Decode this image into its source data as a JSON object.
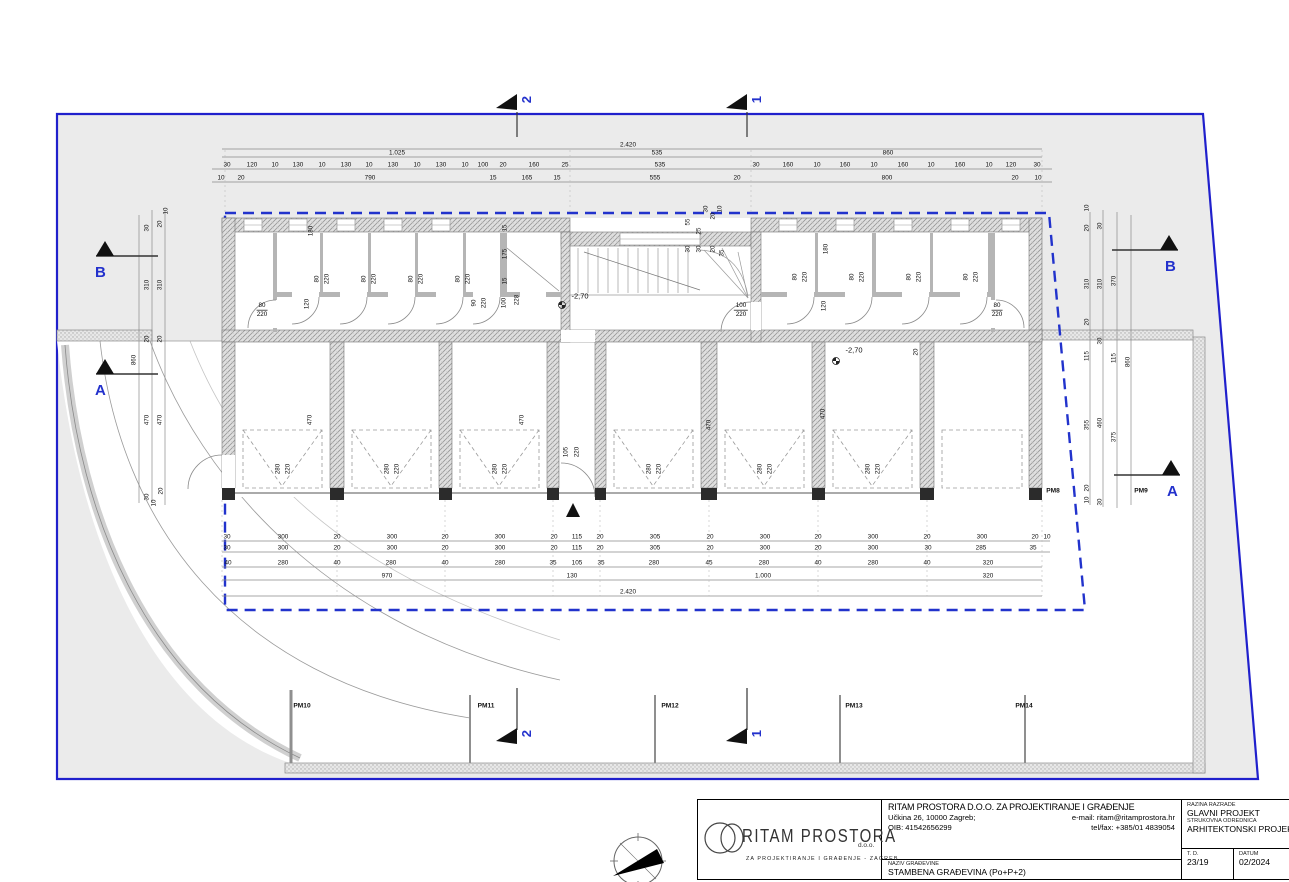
{
  "sheet_title": "STAMBENA GRAĐEVINA (Po+P+2)",
  "tb": {
    "company": "RITAM PROSTORA D.O.O. ZA PROJEKTIRANJE I GRAĐENJE",
    "address": "Učkina 26, 10000 Zagreb;",
    "email": "e-mail: ritam@ritamprostora.hr",
    "oib": "OIB: 41542656299",
    "telfax": "tel/fax: +385/01 4839054",
    "naziv_label": "NAZIV GRAĐEVINE",
    "naziv_value": "STAMBENA GRAĐEVINA (Po+P+2)",
    "razina_label": "RAZINA RAZRADE",
    "razina_value": "GLAVNI PROJEKT",
    "struk_label": "STRUKOVNA ODREDNICA",
    "struk_value": "ARHITEKTONSKI PROJEKT",
    "td_label": "T. D.",
    "td_value": "23/19",
    "datum_label": "DATUM",
    "datum_value": "02/2024",
    "logo_main": "RITAM PROSTORA",
    "logo_doo": "d.o.o.",
    "logo_sub": "ZA  PROJEKTIRANJE  I  GRAĐENJE  -  ZAGREB"
  },
  "markers": {
    "top": [
      {
        "label": "2"
      },
      {
        "label": "1"
      }
    ],
    "bottom": [
      {
        "label": "2"
      },
      {
        "label": "1"
      }
    ],
    "left": [
      {
        "label": "B"
      },
      {
        "label": "A"
      }
    ],
    "right": [
      {
        "label": "B"
      },
      {
        "label": "A"
      }
    ]
  },
  "colors": {
    "parcel_line": "#2020cc",
    "envelope_dash": "#2233cc",
    "marker_blue": "#2331cc"
  },
  "plan": {
    "rooms": [
      {
        "name": "SPREMIŠTE 1",
        "sub": "ker.pl.",
        "area": "3,72 m²",
        "x": 253,
        "y": 262
      },
      {
        "name": "SPREMIŠTE 2",
        "sub": "ker.pl.",
        "area": "2,34 m²",
        "x": 298,
        "y": 244
      },
      {
        "name": "SPREMIŠTE 3",
        "sub": "ker.pl.",
        "area": "2,34 m²",
        "x": 346,
        "y": 230
      },
      {
        "name": "SPREMIŠTE 4",
        "sub": "ker.pl.",
        "area": "2,34 m²",
        "x": 393,
        "y": 246
      },
      {
        "name": "SPREMIŠTE 5",
        "sub": "ker.pl.",
        "area": "2,34 m²",
        "x": 441,
        "y": 230
      },
      {
        "name": "STROJARNICA",
        "name2": "DIZALA",
        "sub": "BPP",
        "area": "1,80 m²",
        "x": 483,
        "y": 243
      },
      {
        "name": "DIZALO",
        "sub": "",
        "area": "2,80 m²",
        "x": 534,
        "y": 247
      },
      {
        "name": "HODNIK",
        "sub": "ker.pl.",
        "area": "8,19 m²",
        "x": 387,
        "y": 296
      },
      {
        "name": "HODNIK / STUBIŠTE",
        "sub": "ker.pl.",
        "area": "22,04 m²",
        "x": 680,
        "y": 292
      },
      {
        "name": "SPREMIŠTE 6",
        "sub": "ker.pl.",
        "area": "2,88 m²",
        "x": 788,
        "y": 239
      },
      {
        "name": "SPREMIŠTE 7",
        "sub": "ker.pl.",
        "area": "2,88 m²",
        "x": 845,
        "y": 239
      },
      {
        "name": "SPREMIŠTE 8",
        "sub": "ker.pl.",
        "area": "2,88 m²",
        "x": 903,
        "y": 239
      },
      {
        "name": "SPREMIŠTE 9",
        "sub": "ker.pl.",
        "area": "2,88 m²",
        "x": 960,
        "y": 239
      },
      {
        "name": "SPREMIŠTE 10",
        "sub": "ker.pl.",
        "area": "3,72 m²",
        "x": 1011,
        "y": 264
      },
      {
        "name": "HODNIK",
        "sub": "ker.pl.",
        "area": "8,36 m²",
        "x": 857,
        "y": 296
      },
      {
        "name": "GARAŽNO PARKIRNO",
        "name2": "MJESTO 1",
        "sub": "BPP",
        "area": "14,70 m²",
        "x": 283,
        "y": 386
      },
      {
        "name": "GARAŽNO PARKIRNO",
        "name2": "MJESTO 2",
        "sub": "BPP",
        "area": "14,70 m²",
        "x": 392,
        "y": 386
      },
      {
        "name": "GARAŽNO PARKIRNO",
        "name2": "MJESTO 3",
        "sub": "BPP",
        "area": "14,70 m²",
        "x": 500,
        "y": 386
      },
      {
        "name": "GARAŽNO PARKIRNO",
        "name2": "MJESTO 4",
        "sub": "BPP",
        "area": "14,95 m²",
        "x": 654,
        "y": 386
      },
      {
        "name": "GARAŽNO PARKIRNO",
        "name2": "MJESTO 5",
        "sub": "BPP",
        "area": "14,70 m²",
        "x": 765,
        "y": 386
      },
      {
        "name": "GARAŽNO PARKIRNO",
        "name2": "MJESTO 6",
        "sub": "BPP",
        "area": "14,70 m²",
        "x": 873,
        "y": 386
      },
      {
        "name": "NATKRIVENO PARKIRNO",
        "name2": "MJESTO 7",
        "sub": "BPP",
        "area": "15,28 m²",
        "x": 982,
        "y": 386
      }
    ],
    "dims_top": [
      {
        "y": 145,
        "items": [
          {
            "t": "2.420",
            "x": 628
          }
        ]
      },
      {
        "y": 153,
        "items": [
          {
            "t": "1.025",
            "x": 397
          },
          {
            "t": "535",
            "x": 657
          },
          {
            "t": "860",
            "x": 888
          }
        ]
      },
      {
        "y": 165,
        "items": [
          {
            "t": "30",
            "x": 227
          },
          {
            "t": "120",
            "x": 252
          },
          {
            "t": "10",
            "x": 275
          },
          {
            "t": "130",
            "x": 298
          },
          {
            "t": "10",
            "x": 322
          },
          {
            "t": "130",
            "x": 346
          },
          {
            "t": "10",
            "x": 369
          },
          {
            "t": "130",
            "x": 393
          },
          {
            "t": "10",
            "x": 417
          },
          {
            "t": "130",
            "x": 441
          },
          {
            "t": "10",
            "x": 465
          },
          {
            "t": "100",
            "x": 483
          },
          {
            "t": "20",
            "x": 503
          },
          {
            "t": "160",
            "x": 534
          },
          {
            "t": "25",
            "x": 565
          },
          {
            "t": "535",
            "x": 660
          },
          {
            "t": "30",
            "x": 756
          },
          {
            "t": "160",
            "x": 788
          },
          {
            "t": "10",
            "x": 817
          },
          {
            "t": "160",
            "x": 845
          },
          {
            "t": "10",
            "x": 874
          },
          {
            "t": "160",
            "x": 903
          },
          {
            "t": "10",
            "x": 931
          },
          {
            "t": "160",
            "x": 960
          },
          {
            "t": "10",
            "x": 989
          },
          {
            "t": "120",
            "x": 1011
          },
          {
            "t": "30",
            "x": 1037
          }
        ]
      },
      {
        "y": 178,
        "items": [
          {
            "t": "10",
            "x": 221
          },
          {
            "t": "20",
            "x": 241
          },
          {
            "t": "790",
            "x": 370
          },
          {
            "t": "15",
            "x": 493
          },
          {
            "t": "165",
            "x": 527
          },
          {
            "t": "15",
            "x": 557
          },
          {
            "t": "555",
            "x": 655
          },
          {
            "t": "20",
            "x": 737
          },
          {
            "t": "800",
            "x": 887
          },
          {
            "t": "20",
            "x": 1015
          },
          {
            "t": "10",
            "x": 1038
          }
        ]
      }
    ],
    "dims_bottom": [
      {
        "y": 537,
        "items": [
          {
            "t": "30",
            "x": 227
          },
          {
            "t": "300",
            "x": 283
          },
          {
            "t": "20",
            "x": 337
          },
          {
            "t": "300",
            "x": 392
          },
          {
            "t": "20",
            "x": 445
          },
          {
            "t": "300",
            "x": 500
          },
          {
            "t": "20",
            "x": 554
          },
          {
            "t": "115",
            "x": 577
          },
          {
            "t": "20",
            "x": 600
          },
          {
            "t": "305",
            "x": 655
          },
          {
            "t": "20",
            "x": 710
          },
          {
            "t": "300",
            "x": 765
          },
          {
            "t": "20",
            "x": 818
          },
          {
            "t": "300",
            "x": 873
          },
          {
            "t": "20",
            "x": 927
          },
          {
            "t": "300",
            "x": 982
          },
          {
            "t": "20",
            "x": 1035
          },
          {
            "t": "10",
            "x": 1047
          }
        ]
      },
      {
        "y": 548,
        "items": [
          {
            "t": "30",
            "x": 227
          },
          {
            "t": "300",
            "x": 283
          },
          {
            "t": "20",
            "x": 337
          },
          {
            "t": "300",
            "x": 392
          },
          {
            "t": "20",
            "x": 445
          },
          {
            "t": "300",
            "x": 500
          },
          {
            "t": "20",
            "x": 554
          },
          {
            "t": "115",
            "x": 577
          },
          {
            "t": "20",
            "x": 600
          },
          {
            "t": "305",
            "x": 655
          },
          {
            "t": "20",
            "x": 710
          },
          {
            "t": "300",
            "x": 765
          },
          {
            "t": "20",
            "x": 818
          },
          {
            "t": "300",
            "x": 873
          },
          {
            "t": "30",
            "x": 928
          },
          {
            "t": "285",
            "x": 981
          },
          {
            "t": "35",
            "x": 1033
          }
        ]
      },
      {
        "y": 563,
        "items": [
          {
            "t": "40",
            "x": 228
          },
          {
            "t": "280",
            "x": 283
          },
          {
            "t": "40",
            "x": 337
          },
          {
            "t": "280",
            "x": 391
          },
          {
            "t": "40",
            "x": 445
          },
          {
            "t": "280",
            "x": 500
          },
          {
            "t": "35",
            "x": 553
          },
          {
            "t": "105",
            "x": 577
          },
          {
            "t": "35",
            "x": 601
          },
          {
            "t": "280",
            "x": 654
          },
          {
            "t": "45",
            "x": 709
          },
          {
            "t": "280",
            "x": 764
          },
          {
            "t": "40",
            "x": 818
          },
          {
            "t": "280",
            "x": 873
          },
          {
            "t": "40",
            "x": 927
          },
          {
            "t": "320",
            "x": 988
          }
        ]
      },
      {
        "y": 576,
        "items": [
          {
            "t": "970",
            "x": 387
          },
          {
            "t": "130",
            "x": 572
          },
          {
            "t": "1.000",
            "x": 763
          },
          {
            "t": "320",
            "x": 988
          }
        ]
      },
      {
        "y": 592,
        "items": [
          {
            "t": "2.420",
            "x": 628
          }
        ]
      }
    ],
    "dims_left": [
      {
        "t": "10",
        "x": 166,
        "y": 211
      },
      {
        "t": "20",
        "x": 160,
        "y": 224
      },
      {
        "t": "30",
        "x": 147,
        "y": 228
      },
      {
        "t": "310",
        "x": 147,
        "y": 285
      },
      {
        "t": "310",
        "x": 160,
        "y": 285
      },
      {
        "t": "20",
        "x": 147,
        "y": 339
      },
      {
        "t": "20",
        "x": 160,
        "y": 339
      },
      {
        "t": "860",
        "x": 134,
        "y": 360
      },
      {
        "t": "470",
        "x": 147,
        "y": 420
      },
      {
        "t": "470",
        "x": 160,
        "y": 420
      },
      {
        "t": "30",
        "x": 147,
        "y": 497
      },
      {
        "t": "10",
        "x": 154,
        "y": 503
      },
      {
        "t": "20",
        "x": 161,
        "y": 491
      }
    ],
    "dims_right": [
      {
        "t": "10",
        "x": 1087,
        "y": 208
      },
      {
        "t": "20",
        "x": 1087,
        "y": 228
      },
      {
        "t": "30",
        "x": 1100,
        "y": 226
      },
      {
        "t": "310",
        "x": 1087,
        "y": 284
      },
      {
        "t": "310",
        "x": 1100,
        "y": 284
      },
      {
        "t": "370",
        "x": 1114,
        "y": 281
      },
      {
        "t": "20",
        "x": 1087,
        "y": 322
      },
      {
        "t": "30",
        "x": 1100,
        "y": 341
      },
      {
        "t": "115",
        "x": 1087,
        "y": 356
      },
      {
        "t": "115",
        "x": 1114,
        "y": 358
      },
      {
        "t": "860",
        "x": 1128,
        "y": 362
      },
      {
        "t": "355",
        "x": 1087,
        "y": 425
      },
      {
        "t": "460",
        "x": 1100,
        "y": 423
      },
      {
        "t": "375",
        "x": 1114,
        "y": 437
      },
      {
        "t": "20",
        "x": 1087,
        "y": 488
      },
      {
        "t": "10",
        "x": 1087,
        "y": 500
      },
      {
        "t": "30",
        "x": 1100,
        "y": 502
      }
    ],
    "rot_dims": [
      {
        "t": "180",
        "x": 311,
        "y": 231
      },
      {
        "t": "120",
        "x": 307,
        "y": 304
      },
      {
        "t": "80",
        "x": 317,
        "y": 279
      },
      {
        "t": "220",
        "x": 327,
        "y": 279
      },
      {
        "t": "80",
        "x": 364,
        "y": 279
      },
      {
        "t": "220",
        "x": 374,
        "y": 279
      },
      {
        "t": "80",
        "x": 411,
        "y": 279
      },
      {
        "t": "220",
        "x": 421,
        "y": 279
      },
      {
        "t": "80",
        "x": 458,
        "y": 279
      },
      {
        "t": "220",
        "x": 468,
        "y": 279
      },
      {
        "t": "90",
        "x": 474,
        "y": 303
      },
      {
        "t": "220",
        "x": 484,
        "y": 303
      },
      {
        "t": "15",
        "x": 505,
        "y": 228
      },
      {
        "t": "175",
        "x": 505,
        "y": 254
      },
      {
        "t": "15",
        "x": 505,
        "y": 281
      },
      {
        "t": "100",
        "x": 504,
        "y": 303
      },
      {
        "t": "228",
        "x": 517,
        "y": 300
      },
      {
        "t": "55",
        "x": 688,
        "y": 222
      },
      {
        "t": "30",
        "x": 688,
        "y": 249
      },
      {
        "t": "25",
        "x": 699,
        "y": 231
      },
      {
        "t": "30",
        "x": 699,
        "y": 249
      },
      {
        "t": "30",
        "x": 706,
        "y": 209
      },
      {
        "t": "20",
        "x": 713,
        "y": 216
      },
      {
        "t": "10",
        "x": 720,
        "y": 209
      },
      {
        "t": "20",
        "x": 713,
        "y": 249
      },
      {
        "t": "35",
        "x": 722,
        "y": 253
      },
      {
        "t": "180",
        "x": 826,
        "y": 249
      },
      {
        "t": "120",
        "x": 824,
        "y": 306
      },
      {
        "t": "80",
        "x": 795,
        "y": 277
      },
      {
        "t": "220",
        "x": 805,
        "y": 277
      },
      {
        "t": "80",
        "x": 852,
        "y": 277
      },
      {
        "t": "220",
        "x": 862,
        "y": 277
      },
      {
        "t": "80",
        "x": 909,
        "y": 277
      },
      {
        "t": "220",
        "x": 919,
        "y": 277
      },
      {
        "t": "80",
        "x": 966,
        "y": 277
      },
      {
        "t": "220",
        "x": 976,
        "y": 277
      },
      {
        "t": "470",
        "x": 310,
        "y": 420
      },
      {
        "t": "470",
        "x": 522,
        "y": 420
      },
      {
        "t": "470",
        "x": 709,
        "y": 425
      },
      {
        "t": "470",
        "x": 823,
        "y": 414
      },
      {
        "t": "280",
        "x": 278,
        "y": 469
      },
      {
        "t": "220",
        "x": 288,
        "y": 469
      },
      {
        "t": "280",
        "x": 387,
        "y": 469
      },
      {
        "t": "220",
        "x": 397,
        "y": 469
      },
      {
        "t": "280",
        "x": 495,
        "y": 469
      },
      {
        "t": "220",
        "x": 505,
        "y": 469
      },
      {
        "t": "105",
        "x": 566,
        "y": 452
      },
      {
        "t": "220",
        "x": 577,
        "y": 452
      },
      {
        "t": "280",
        "x": 649,
        "y": 469
      },
      {
        "t": "220",
        "x": 659,
        "y": 469
      },
      {
        "t": "280",
        "x": 760,
        "y": 469
      },
      {
        "t": "220",
        "x": 770,
        "y": 469
      },
      {
        "t": "280",
        "x": 868,
        "y": 469
      },
      {
        "t": "220",
        "x": 878,
        "y": 469
      },
      {
        "t": "20",
        "x": 916,
        "y": 352
      }
    ],
    "door_dims": [
      {
        "top": "80",
        "bot": "220",
        "x": 262,
        "y": 310
      },
      {
        "top": "100",
        "bot": "220",
        "x": 741,
        "y": 310
      },
      {
        "top": "80",
        "bot": "220",
        "x": 997,
        "y": 310
      }
    ],
    "levels": [
      {
        "t": "-2,70",
        "x": 580,
        "y": 296
      },
      {
        "t": "-2,70",
        "x": 854,
        "y": 350
      }
    ],
    "pm_labels": [
      {
        "t": "PM8",
        "x": 1053,
        "y": 491
      },
      {
        "t": "PM9",
        "x": 1141,
        "y": 491
      },
      {
        "t": "PM10",
        "x": 302,
        "y": 706
      },
      {
        "t": "PM11",
        "x": 486,
        "y": 706
      },
      {
        "t": "PM12",
        "x": 670,
        "y": 706
      },
      {
        "t": "PM13",
        "x": 854,
        "y": 706
      },
      {
        "t": "PM14",
        "x": 1024,
        "y": 706
      }
    ]
  }
}
